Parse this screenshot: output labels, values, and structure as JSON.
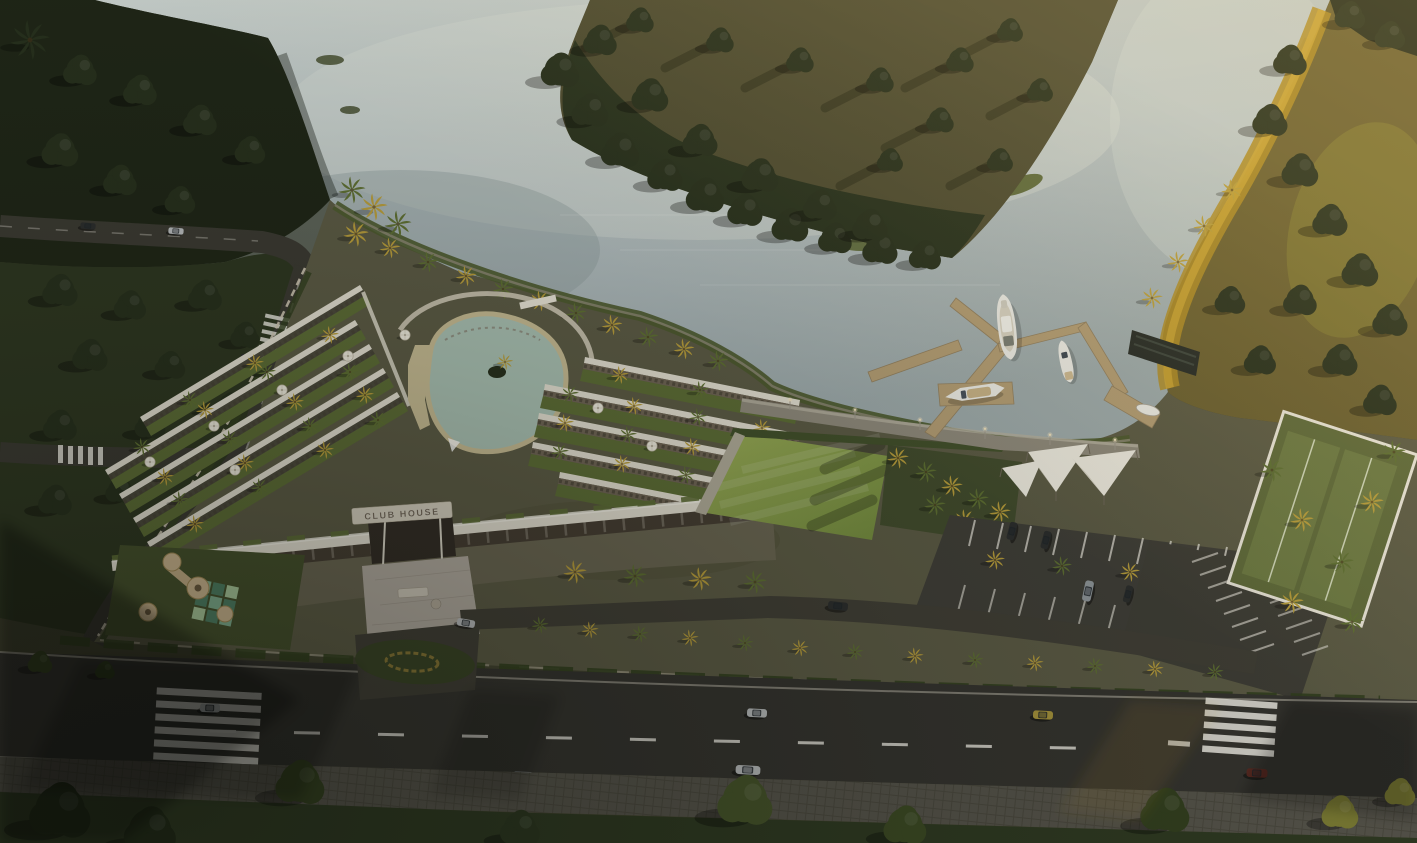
{
  "scene": {
    "description": "Aerial architectural rendering of a riverside club house resort at golden hour: rooftop garden terraces with white umbrellas and palms, a central lagoon pool, an event lawn, a marina with a yacht, motorboat and speedboat at timber docks, white shade sails, parking lots, and a tree-lined avenue with passing cars. A calm river with forested and golden-lit banks wraps the site.",
    "counts": {
      "boats": 4,
      "vehicles": 15,
      "umbrellas": 8,
      "shade_sails": 3,
      "street_lamps": 6,
      "crosswalks": 4
    }
  },
  "sign": {
    "text": "CLUB HOUSE"
  },
  "colors": {
    "water": "#b3bec0",
    "waterBright": "#d2d9d3",
    "waterShade": "#8d9a9b",
    "pool": "#a9c0b2",
    "sand": "#c6bb93",
    "forest": "#2e3722",
    "forestDark": "#1f2617",
    "field": "#4e4c31",
    "bank": "#26301d",
    "gold": "#b08d26",
    "goldBright": "#d3ab38",
    "grassLawn": "#7e9747",
    "grassLawnLight": "#9aad57",
    "planter": "#5d6d36",
    "palm": "#5f7033",
    "palmGold": "#b99e3c",
    "treeDark": "#27301d",
    "ground": "#6a6652",
    "siteGround": "#5c5b45",
    "asphalt": "#35342f",
    "asphaltLight": "#413f36",
    "roadLeft": "#3b3a32",
    "sidewalk": "#56544b",
    "curb": "#cfcabc",
    "marking": "#e8e6dd",
    "building": "#e3dfd1",
    "buildingHi": "#f3f0e6",
    "arcade": "#463e33",
    "marble": "#b2aba0",
    "dock": "#b39d74",
    "dockShade": "#93805f",
    "sail": "#efece1",
    "boat": "#ecece6",
    "carSilver": "#b9bcbd",
    "carGrey": "#8f969a",
    "carGold": "#a8953c",
    "carMaroon": "#5a2a22",
    "carDark": "#2c2e2d",
    "signText": "#6e6354",
    "signPlate": "#d6d0c0",
    "hedge": "#33401f",
    "lawnDark": "#2f3a22",
    "parkGreen": "#2e3721",
    "play": "#cbb58f"
  }
}
